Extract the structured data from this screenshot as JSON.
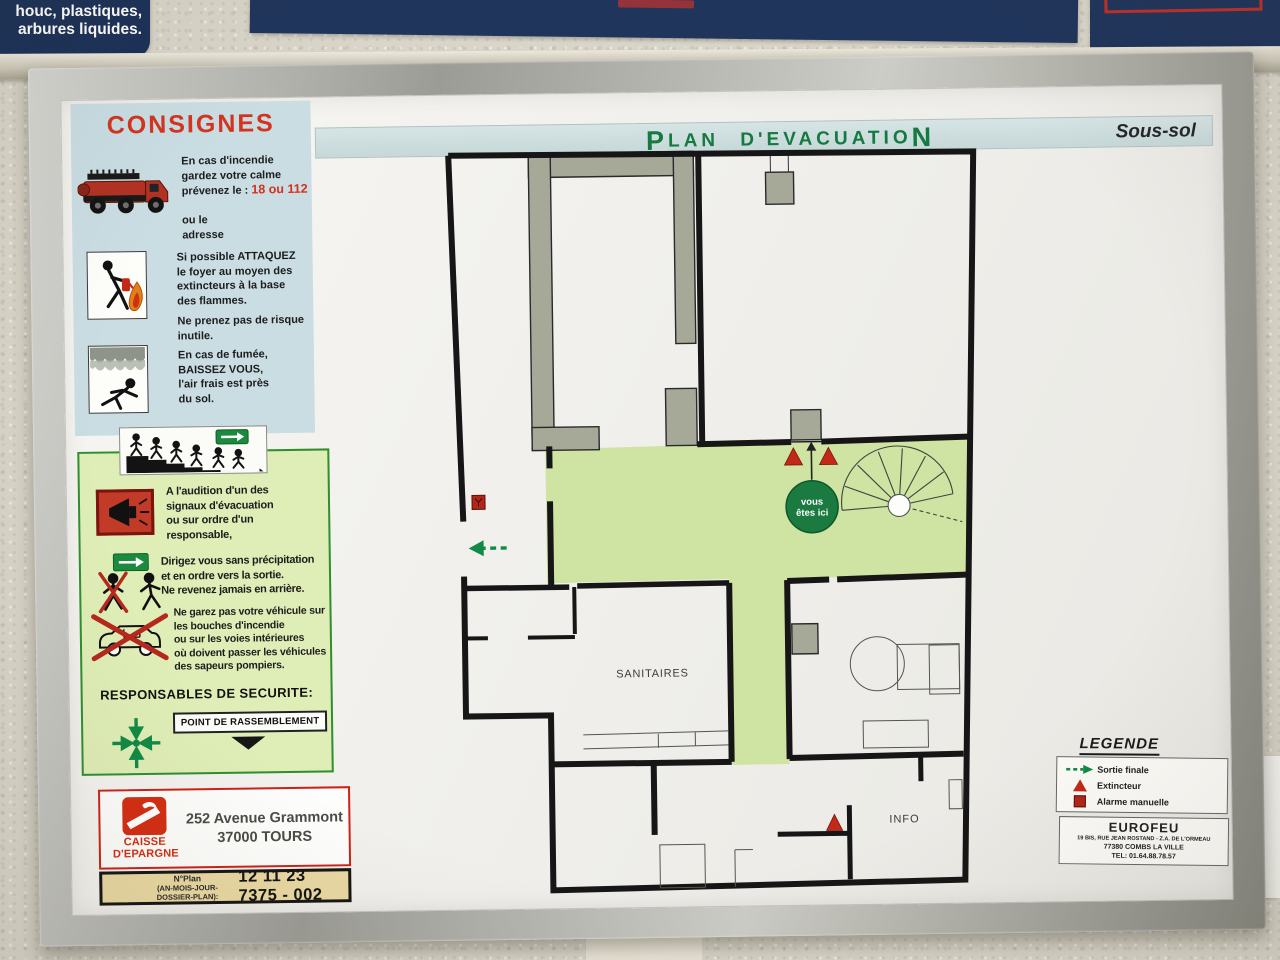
{
  "wall": {
    "left_sign_lines": [
      "er, carton, chiffons,",
      "houc, plastiques,",
      "arbures liquides."
    ]
  },
  "header": {
    "title_first": "P",
    "title_mid": "LAN D'EVACUATIO",
    "title_last": "N",
    "floor": "Sous-sol"
  },
  "consignes": {
    "title": "CONSIGNES",
    "fire_text": "En cas d'incendie\ngardez votre calme\nprévenez le : ",
    "fire_phone": "18 ou 112",
    "fire_text2": "\n\nou le\nadresse",
    "attack_text": "Si possible ATTAQUEZ\nle foyer au moyen des\nextincteurs à la base\ndes flammes.",
    "attack_text2": "Ne prenez pas de risque\ninutile.",
    "smoke_text": "En cas de fumée,\nBAISSEZ VOUS,\nl'air frais est près\ndu sol."
  },
  "evacuation": {
    "alarm_text": "A l'audition d'un des\nsignaux d'évacuation\nou sur ordre d'un\nresponsable,",
    "direct_text": "Dirigez vous sans précipitation\net en ordre vers la sortie.\nNe revenez jamais en arrière.",
    "vehicle_text": "Ne garez pas votre véhicule sur\nles bouches d'incendie\nou sur les voies intérieures\noù doivent passer les véhicules\ndes sapeurs pompiers.",
    "responsables": "RESPONSABLES DE SECURITE:",
    "rassemblement": "POINT DE RASSEMBLEMENT"
  },
  "plan": {
    "sanitaires": "SANITAIRES",
    "info": "INFO",
    "you_line1": "vous",
    "you_line2": "êtes ici"
  },
  "legend": {
    "title": "LEGENDE",
    "items": [
      {
        "label": "Sortie finale"
      },
      {
        "label": "Extincteur"
      },
      {
        "label": "Alarme manuelle"
      }
    ]
  },
  "eurofeu": {
    "name": "EUROFEU",
    "address1": "19 BIS, RUE JEAN ROSTAND - Z.A. DE L'ORMEAU",
    "address2": "77380 COMBS LA VILLE",
    "tel": "TEL: 01.64.88.78.57"
  },
  "owner": {
    "brand1": "CAISSE",
    "brand2": "D'EPARGNE",
    "address": "252 Avenue Grammont\n37000 TOURS"
  },
  "plan_number": {
    "label1": "N°Plan",
    "label2": "(AN-MOIS-JOUR-DOSSIER-PLAN):",
    "value": "12 11 23 7375 - 002"
  },
  "colors": {
    "title_green": "#157a42",
    "corridor_green": "#cfe3a2",
    "panel_blue": "#c9dde3",
    "panel_green": "#dfedb6",
    "alert_red": "#c22918",
    "brand_red": "#d42e12",
    "navy_poster": "#1c3158",
    "wall_black": "#161616"
  }
}
